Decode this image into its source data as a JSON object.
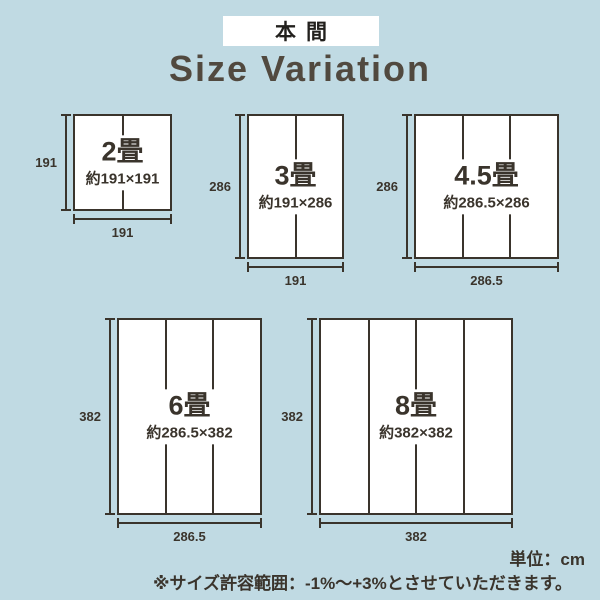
{
  "badge": {
    "label": "本間"
  },
  "title": "Size Variation",
  "mats": [
    {
      "name": "2畳",
      "size_label": "約191×191",
      "height_label": "191",
      "width_label": "191"
    },
    {
      "name": "3畳",
      "size_label": "約191×286",
      "height_label": "286",
      "width_label": "191"
    },
    {
      "name": "4.5畳",
      "size_label": "約286.5×286",
      "height_label": "286",
      "width_label": "286.5"
    },
    {
      "name": "6畳",
      "size_label": "約286.5×382",
      "height_label": "382",
      "width_label": "286.5"
    },
    {
      "name": "8畳",
      "size_label": "約382×382",
      "height_label": "382",
      "width_label": "382"
    }
  ],
  "footer": {
    "unit_label": "単位：cm",
    "tolerance_note": "※サイズ許容範囲：-1%〜+3%とさせていただきます。"
  },
  "colors": {
    "background": "#c0dae3",
    "ink": "#3a342c",
    "title_color": "#51493f",
    "panel": "#ffffff"
  }
}
